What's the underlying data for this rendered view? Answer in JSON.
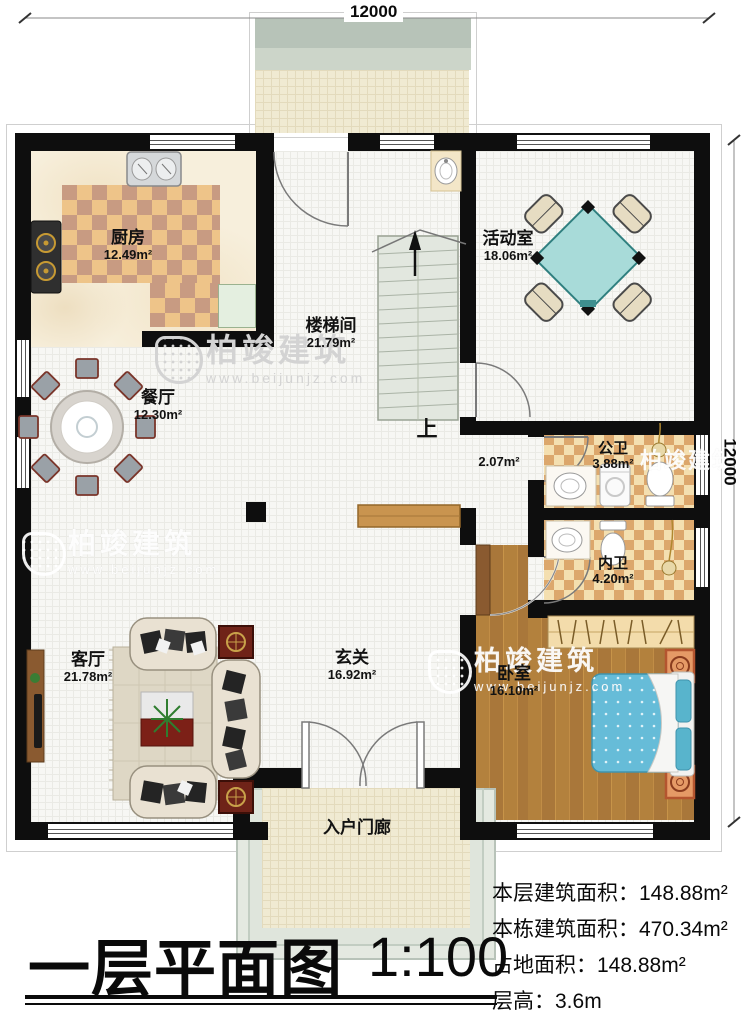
{
  "meta": {
    "brand": "柏竣建筑",
    "brand_url": "www.beijunjz.com"
  },
  "dimensions": {
    "top": "12000",
    "right": "12000"
  },
  "rooms": {
    "kitchen": {
      "name": "厨房",
      "area": "12.49m²"
    },
    "stairwell": {
      "name": "楼梯间",
      "area": "21.79m²"
    },
    "activity": {
      "name": "活动室",
      "area": "18.06m²"
    },
    "dining": {
      "name": "餐厅",
      "area": "12.30m²"
    },
    "public_bath": {
      "name": "公卫",
      "area": "3.88m²"
    },
    "private_bath": {
      "name": "内卫",
      "area": "4.20m²"
    },
    "bedroom": {
      "name": "卧室",
      "area": "16.10m²"
    },
    "living": {
      "name": "客厅",
      "area": "21.78m²"
    },
    "foyer": {
      "name": "玄关",
      "area": "16.92m²"
    },
    "porch": {
      "name": "入户门廊"
    },
    "corridor": {
      "area": "2.07m²"
    },
    "stairs": {
      "up_label": "上"
    }
  },
  "title": {
    "text": "一层平面图",
    "scale": "1:100"
  },
  "stats": {
    "floor_area": {
      "label": "本层建筑面积：",
      "value": "148.88m²"
    },
    "building_area": {
      "label": "本栋建筑面积：",
      "value": "470.34m²"
    },
    "footprint_area": {
      "label": "占地面积：",
      "value": "148.88m²"
    },
    "floor_height": {
      "label": "层高：",
      "value": "3.6m"
    }
  }
}
